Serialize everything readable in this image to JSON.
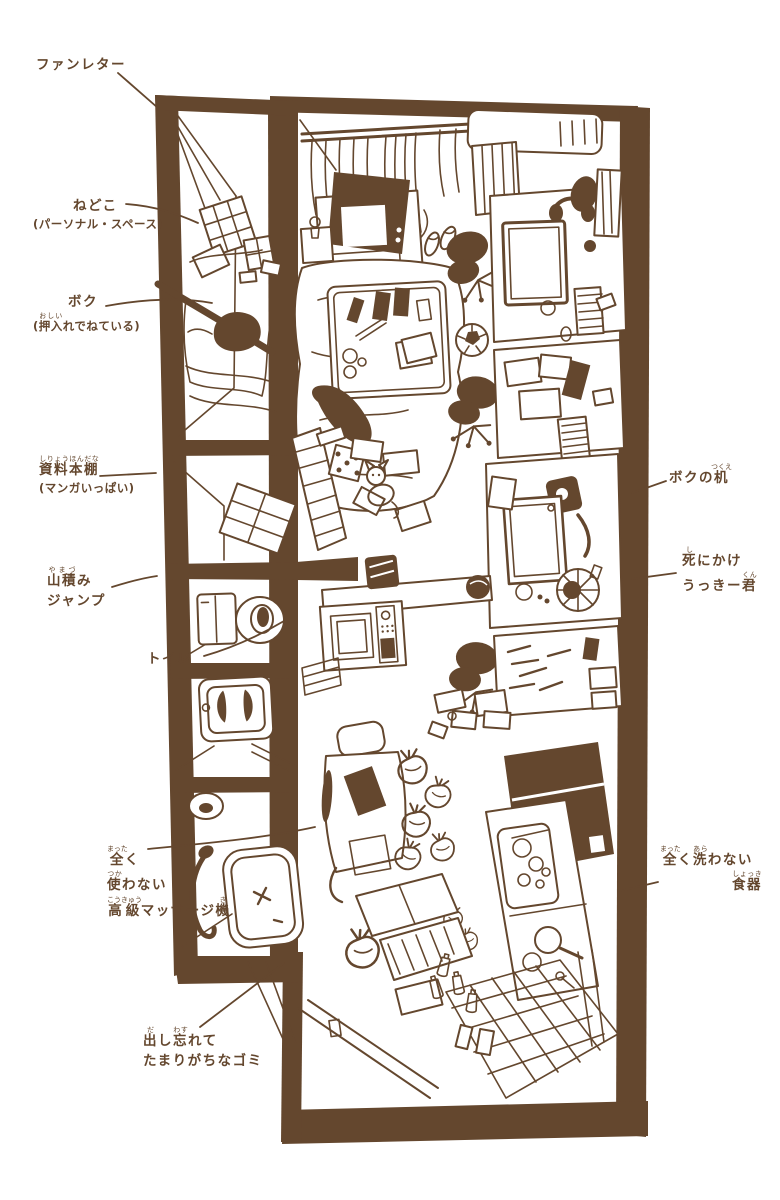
{
  "palette": {
    "ink": "#64472e",
    "paper": "#ffffff"
  },
  "illustration": {
    "description": "hand-drawn top-down view of a cluttered one-room apartment",
    "rooms": [
      "closet-bed",
      "bookshelf-closet",
      "toilet",
      "laundry",
      "bathroom",
      "main-room",
      "kitchen",
      "entrance"
    ]
  },
  "labels": {
    "fan_letter": {
      "text": "ファンレター"
    },
    "nedoko": {
      "line1": "ねどこ",
      "line2": "(パーソナル・スペース)"
    },
    "boku": {
      "line1": "ボク",
      "open": "(",
      "base": "押入",
      "ruby": "おしい",
      "rest": "れでねている)"
    },
    "shiryo": {
      "base": "資料本棚",
      "ruby": "しりょうほんだな",
      "line2": "(マンガいっぱい)"
    },
    "yamazumi": {
      "base": "山積",
      "ruby": "やまづ",
      "rest": "み",
      "line2": "ジャンプ"
    },
    "toilet": {
      "text": "トイレ"
    },
    "desk": {
      "pre": "ボクの",
      "base": "机",
      "ruby": "つくえ"
    },
    "ukki": {
      "base1": "死",
      "ruby1": "し",
      "rest1": "にかけ",
      "pre2": "うっきー",
      "base2": "君",
      "ruby2": "くん"
    },
    "massage": {
      "b1": "全",
      "r1": "まった",
      "t1": "く",
      "b2": "使",
      "r2": "つか",
      "t2": "わない",
      "b3": "高級",
      "r3": "こうきゅう",
      "t3": "マッサージ",
      "b4": "機",
      "r4": "き"
    },
    "dishes": {
      "b1": "全",
      "r1": "まった",
      "t1": "く",
      "b2": "洗",
      "r2": "あら",
      "t2": "わない",
      "b3": "食器",
      "r3": "しょっき"
    },
    "garbage": {
      "b1": "出",
      "r1": "だ",
      "t1": "し",
      "b2": "忘",
      "r2": "わす",
      "t2": "れて",
      "line2": "たまりがちなゴミ"
    }
  }
}
